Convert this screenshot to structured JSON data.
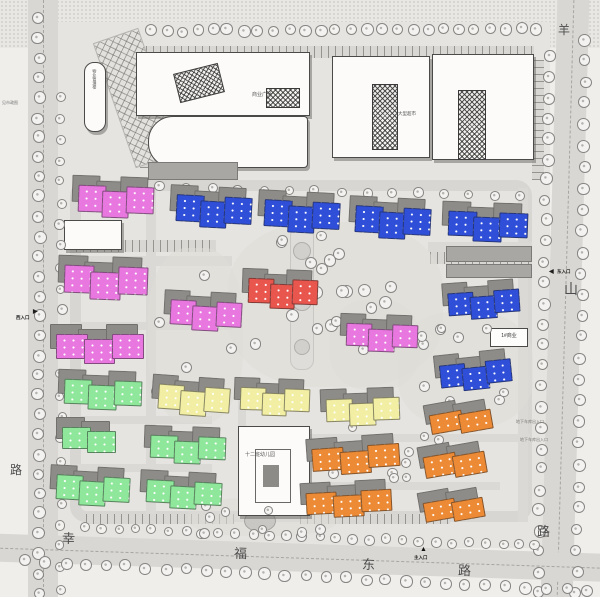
{
  "roads": {
    "bottom": [
      "幸",
      "福",
      "东",
      "路"
    ],
    "right": [
      "羊",
      "山",
      "路"
    ],
    "left": [
      "路"
    ]
  },
  "entrances": {
    "west_icon": "▶",
    "west": "西入口",
    "east_icon": "◀",
    "east": "东入口",
    "south_icon": "▲",
    "south": "主入口"
  },
  "labels": {
    "management": "物业管理楼",
    "plaza": "商业广场",
    "supermarket": "大型超市",
    "kindergarten": "十二班幼儿园",
    "commercial": "1#商业",
    "note_right_1": "地下车库出入口",
    "note_right_2": "地下车库出入口",
    "note_left": "见市政图"
  },
  "colors": {
    "magenta": "#E878E0",
    "blue": "#2F4FD8",
    "red": "#E8564E",
    "green": "#8FE79B",
    "yellow": "#F2EFA4",
    "orange": "#EC8A35",
    "shadow": "#8E8C89",
    "road": "#D9D7D3",
    "site": "#E6E4E0"
  },
  "buildings": {
    "magenta": [
      [
        78,
        186,
        74,
        30,
        3,
        2
      ],
      [
        64,
        266,
        82,
        32,
        3,
        2
      ],
      [
        56,
        334,
        86,
        28,
        3,
        0
      ],
      [
        170,
        301,
        70,
        28,
        3,
        3
      ],
      [
        346,
        324,
        70,
        26,
        3,
        2
      ]
    ],
    "red": [
      [
        248,
        279,
        68,
        28,
        3,
        2
      ]
    ],
    "blue": [
      [
        176,
        196,
        74,
        30,
        3,
        3
      ],
      [
        264,
        201,
        74,
        30,
        3,
        3
      ],
      [
        355,
        207,
        74,
        30,
        3,
        3
      ],
      [
        448,
        212,
        78,
        28,
        3,
        2
      ],
      [
        448,
        291,
        70,
        26,
        3,
        -4
      ],
      [
        440,
        362,
        70,
        26,
        3,
        -6
      ]
    ],
    "green": [
      [
        64,
        380,
        76,
        28,
        3,
        2
      ],
      [
        62,
        427,
        52,
        24,
        2,
        0
      ],
      [
        56,
        476,
        72,
        28,
        3,
        3
      ],
      [
        150,
        436,
        74,
        26,
        3,
        2
      ],
      [
        146,
        481,
        74,
        26,
        3,
        3
      ]
    ],
    "yellow": [
      [
        158,
        386,
        70,
        28,
        3,
        4
      ],
      [
        240,
        388,
        68,
        26,
        3,
        2
      ],
      [
        326,
        398,
        72,
        26,
        3,
        -2
      ]
    ],
    "orange": [
      [
        430,
        410,
        60,
        22,
        2,
        -10
      ],
      [
        312,
        446,
        86,
        26,
        3,
        -4
      ],
      [
        424,
        452,
        60,
        24,
        2,
        -10
      ],
      [
        306,
        491,
        84,
        24,
        3,
        -3
      ],
      [
        424,
        498,
        58,
        22,
        2,
        -10
      ]
    ]
  },
  "trees": {
    "lines": [
      [
        150,
        30,
        535,
        28,
        26,
        5
      ],
      [
        38,
        18,
        38,
        592,
        30,
        5
      ],
      [
        60,
        95,
        60,
        588,
        24,
        4
      ],
      [
        548,
        55,
        537,
        592,
        27,
        5
      ],
      [
        585,
        38,
        575,
        592,
        27,
        5
      ],
      [
        85,
        527,
        535,
        545,
        28,
        4
      ],
      [
        25,
        560,
        585,
        590,
        29,
        5
      ],
      [
        160,
        186,
        520,
        196,
        15,
        4
      ]
    ],
    "clusters": [
      [
        245,
        232,
        185,
        145,
        22,
        5
      ],
      [
        152,
        252,
        85,
        160,
        10,
        4
      ],
      [
        405,
        318,
        115,
        100,
        12,
        4
      ],
      [
        198,
        503,
        130,
        32,
        8,
        4
      ],
      [
        330,
        422,
        88,
        60,
        7,
        4
      ],
      [
        398,
        428,
        58,
        38,
        5,
        4
      ]
    ]
  },
  "drives": [
    [
      146,
      188,
      10,
      332
    ],
    [
      72,
      256,
      160,
      10
    ],
    [
      72,
      322,
      160,
      8
    ],
    [
      72,
      416,
      140,
      8
    ],
    [
      72,
      464,
      140,
      8
    ],
    [
      238,
      378,
      8,
      142
    ],
    [
      300,
      434,
      230,
      8
    ],
    [
      300,
      482,
      200,
      8
    ],
    [
      428,
      242,
      104,
      10
    ],
    [
      518,
      188,
      10,
      334
    ]
  ],
  "parking": [
    [
      76,
      240,
      140,
      12
    ],
    [
      430,
      252,
      100,
      12
    ],
    [
      86,
      514,
      148,
      10
    ],
    [
      300,
      514,
      150,
      10
    ],
    [
      140,
      84,
      34,
      84
    ],
    [
      532,
      60,
      12,
      120
    ],
    [
      132,
      46,
      402,
      12
    ]
  ],
  "blobs": [
    [
      228,
      222,
      215,
      165
    ],
    [
      148,
      248,
      95,
      175
    ],
    [
      398,
      312,
      135,
      115
    ],
    [
      188,
      498,
      150,
      38
    ],
    [
      330,
      300,
      90,
      90
    ]
  ],
  "aux_blocks": [
    [
      148,
      162,
      88,
      16
    ],
    [
      446,
      246,
      84,
      14
    ],
    [
      446,
      264,
      84,
      12
    ]
  ]
}
